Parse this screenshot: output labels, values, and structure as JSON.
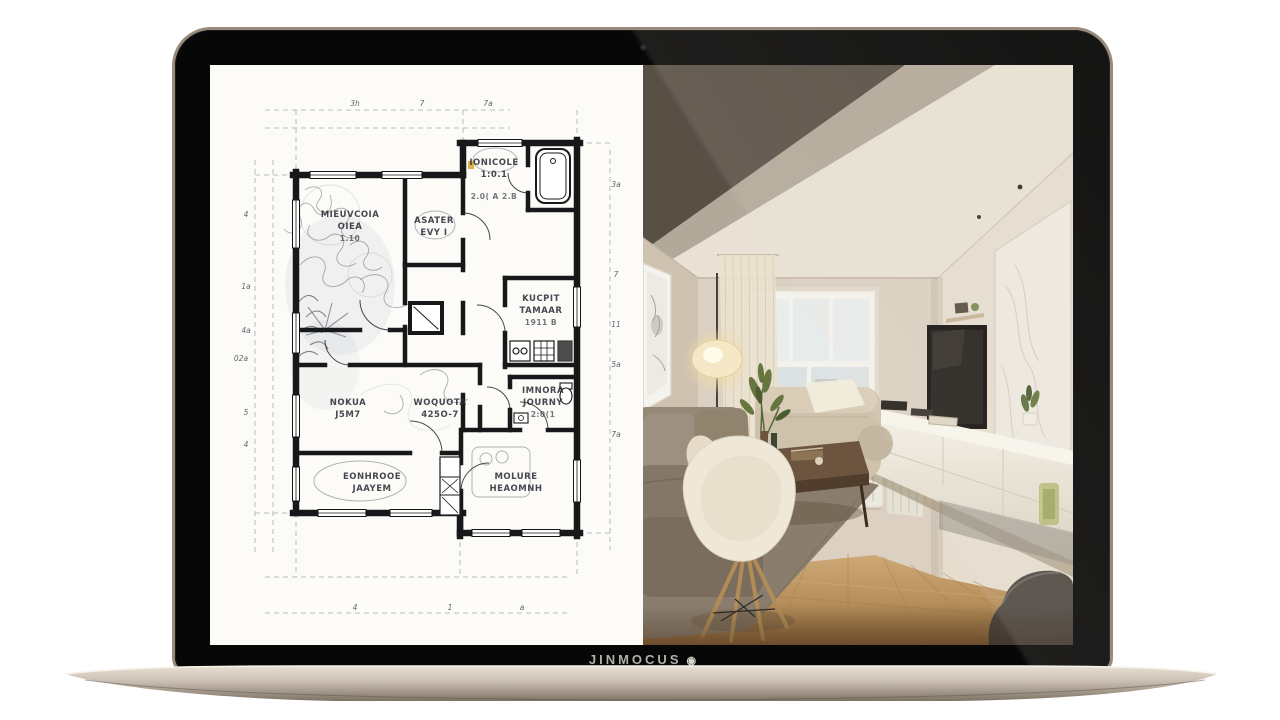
{
  "laptop": {
    "brand_text": "JINMOCUS",
    "logo_glyph": "◉",
    "colors": {
      "bezel": "#070707",
      "edge": "#998b7c",
      "base_top": "#e8e0d4",
      "base_bottom": "#7e7265"
    }
  },
  "screen": {
    "left_pane": "hand-drawn floor plan sketch",
    "right_pane": "photorealistic interior render"
  },
  "floor_plan": {
    "ink_color": "#17181a",
    "paper_color": "#fcfbf8",
    "rooms": [
      {
        "name": "MIEUVCOIA",
        "line2": "OIEA",
        "line3": "1.10"
      },
      {
        "name": "ASATER",
        "line2": "EVY I",
        "line3": ""
      },
      {
        "name": "IONICOLE",
        "line2": "1:0.1",
        "line3": "2.0( A 2.B"
      },
      {
        "name": "KUCPIT",
        "line2": "TAMAAR",
        "line3": "1911 B"
      },
      {
        "name": "IMNORA",
        "line2": "JOURNY",
        "line3": "2:0(1"
      },
      {
        "name": "NOKUA",
        "line2": "J5M7",
        "line3": ""
      },
      {
        "name": "WOQUOTA",
        "line2": "425O-7",
        "line3": ""
      },
      {
        "name": "EONHROOE",
        "line2": "JAAYEM",
        "line3": ""
      },
      {
        "name": "MOLURE",
        "line2": "HEAOMNH",
        "line3": ""
      }
    ],
    "dim_top": [
      "3h",
      "7",
      "7a"
    ],
    "dim_right": [
      "3a",
      "7",
      "11",
      "5a",
      "7a"
    ],
    "dim_left": [
      "4",
      "1a",
      "4a",
      "02a",
      "5",
      "4"
    ],
    "dim_bottom": [
      "4",
      "1",
      "a"
    ]
  },
  "interior": {
    "colors": {
      "wall": "#dbd0c1",
      "ceiling": "#e8e1d4",
      "ceiling_shadow": "#3e352b",
      "floor": "#b8905c",
      "rug": "#8a7d6d",
      "sofa": "#8d7f6d",
      "sofa_beige": "#cfc2ac",
      "chair": "#efe8d9",
      "table": "#6d543f",
      "console": "#f1ece2",
      "plant": "#66763f",
      "lamp_glow": "#f6e8c6"
    }
  }
}
